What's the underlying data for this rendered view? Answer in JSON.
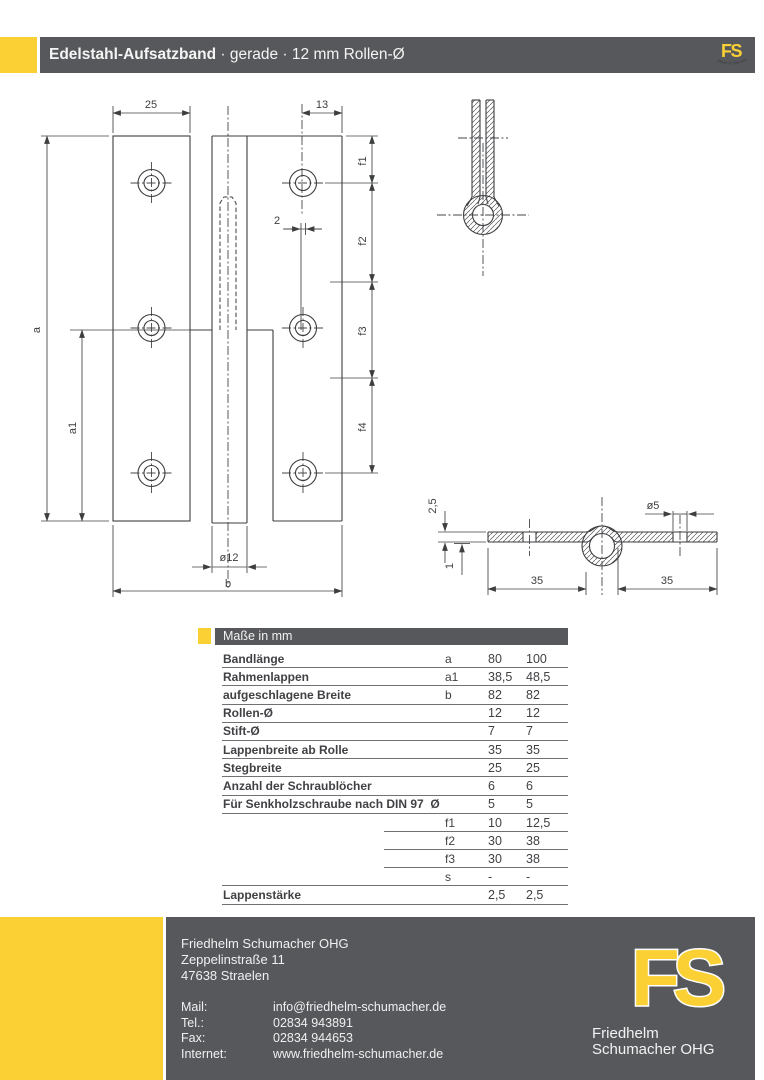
{
  "page": {
    "title_bold": "Edelstahl-Aufsatzband",
    "title_rest": " · gerade · 12 mm Rollen-Ø"
  },
  "logo": {
    "monogram": "FS",
    "tagline": "Made in Germany",
    "name_line1": "Friedhelm",
    "name_line2": "Schumacher OHG"
  },
  "colors": {
    "yellow": "#FBD034",
    "gray": "#57585B"
  },
  "drawing": {
    "front": {
      "dim_width_left": "25",
      "dim_width_right": "13",
      "dim_offset": "2",
      "dim_a": "a",
      "dim_a1": "a1",
      "dim_f1": "f1",
      "dim_f2": "f2",
      "dim_f3": "f3",
      "dim_f4": "f4",
      "dim_roll": "ø12",
      "dim_b": "b"
    },
    "section": {
      "dim_thickness": "2,5",
      "dim_one": "1",
      "dim_hole": "ø5",
      "dim_35_left": "35",
      "dim_35_right": "35"
    }
  },
  "table": {
    "header": "Maße in mm",
    "rows": [
      {
        "label": "Bandlänge",
        "sym": "a",
        "v1": "80",
        "v2": "100",
        "partial": false
      },
      {
        "label": "Rahmenlappen",
        "sym": "a1",
        "v1": "38,5",
        "v2": "48,5",
        "partial": false
      },
      {
        "label": "aufgeschlagene Breite",
        "sym": "b",
        "v1": "82",
        "v2": "82",
        "partial": false
      },
      {
        "label": "Rollen-Ø",
        "sym": "",
        "v1": "12",
        "v2": "12",
        "partial": false
      },
      {
        "label": "Stift-Ø",
        "sym": "",
        "v1": "7",
        "v2": "7",
        "partial": false
      },
      {
        "label": "Lappenbreite ab Rolle",
        "sym": "",
        "v1": "35",
        "v2": "35",
        "partial": false
      },
      {
        "label": "Stegbreite",
        "sym": "",
        "v1": "25",
        "v2": "25",
        "partial": false
      },
      {
        "label": "Anzahl der Schraublöcher",
        "sym": "",
        "v1": "6",
        "v2": "6",
        "partial": false
      },
      {
        "label": "Für Senkholzschraube nach DIN 97  Ø",
        "sym": "",
        "v1": "5",
        "v2": "5",
        "partial": false
      },
      {
        "label": "",
        "sym": "f1",
        "v1": "10",
        "v2": "12,5",
        "partial": true
      },
      {
        "label": "",
        "sym": "f2",
        "v1": "30",
        "v2": "38",
        "partial": true
      },
      {
        "label": "",
        "sym": "f3",
        "v1": "30",
        "v2": "38",
        "partial": true
      },
      {
        "label": "",
        "sym": "s",
        "v1": "-",
        "v2": "-",
        "partial": false
      },
      {
        "label": "Lappenstärke",
        "sym": "",
        "v1": "2,5",
        "v2": "2,5",
        "partial": false
      }
    ]
  },
  "footer": {
    "company": [
      "Friedhelm Schumacher OHG",
      "Zeppelinstraße 11",
      "47638 Straelen"
    ],
    "contacts": [
      {
        "label": "Mail:",
        "value": "info@friedhelm-schumacher.de"
      },
      {
        "label": "Tel.:",
        "value": "02834 943891"
      },
      {
        "label": "Fax:",
        "value": "02834 944653"
      },
      {
        "label": "Internet:",
        "value": "www.friedhelm-schumacher.de"
      }
    ]
  }
}
